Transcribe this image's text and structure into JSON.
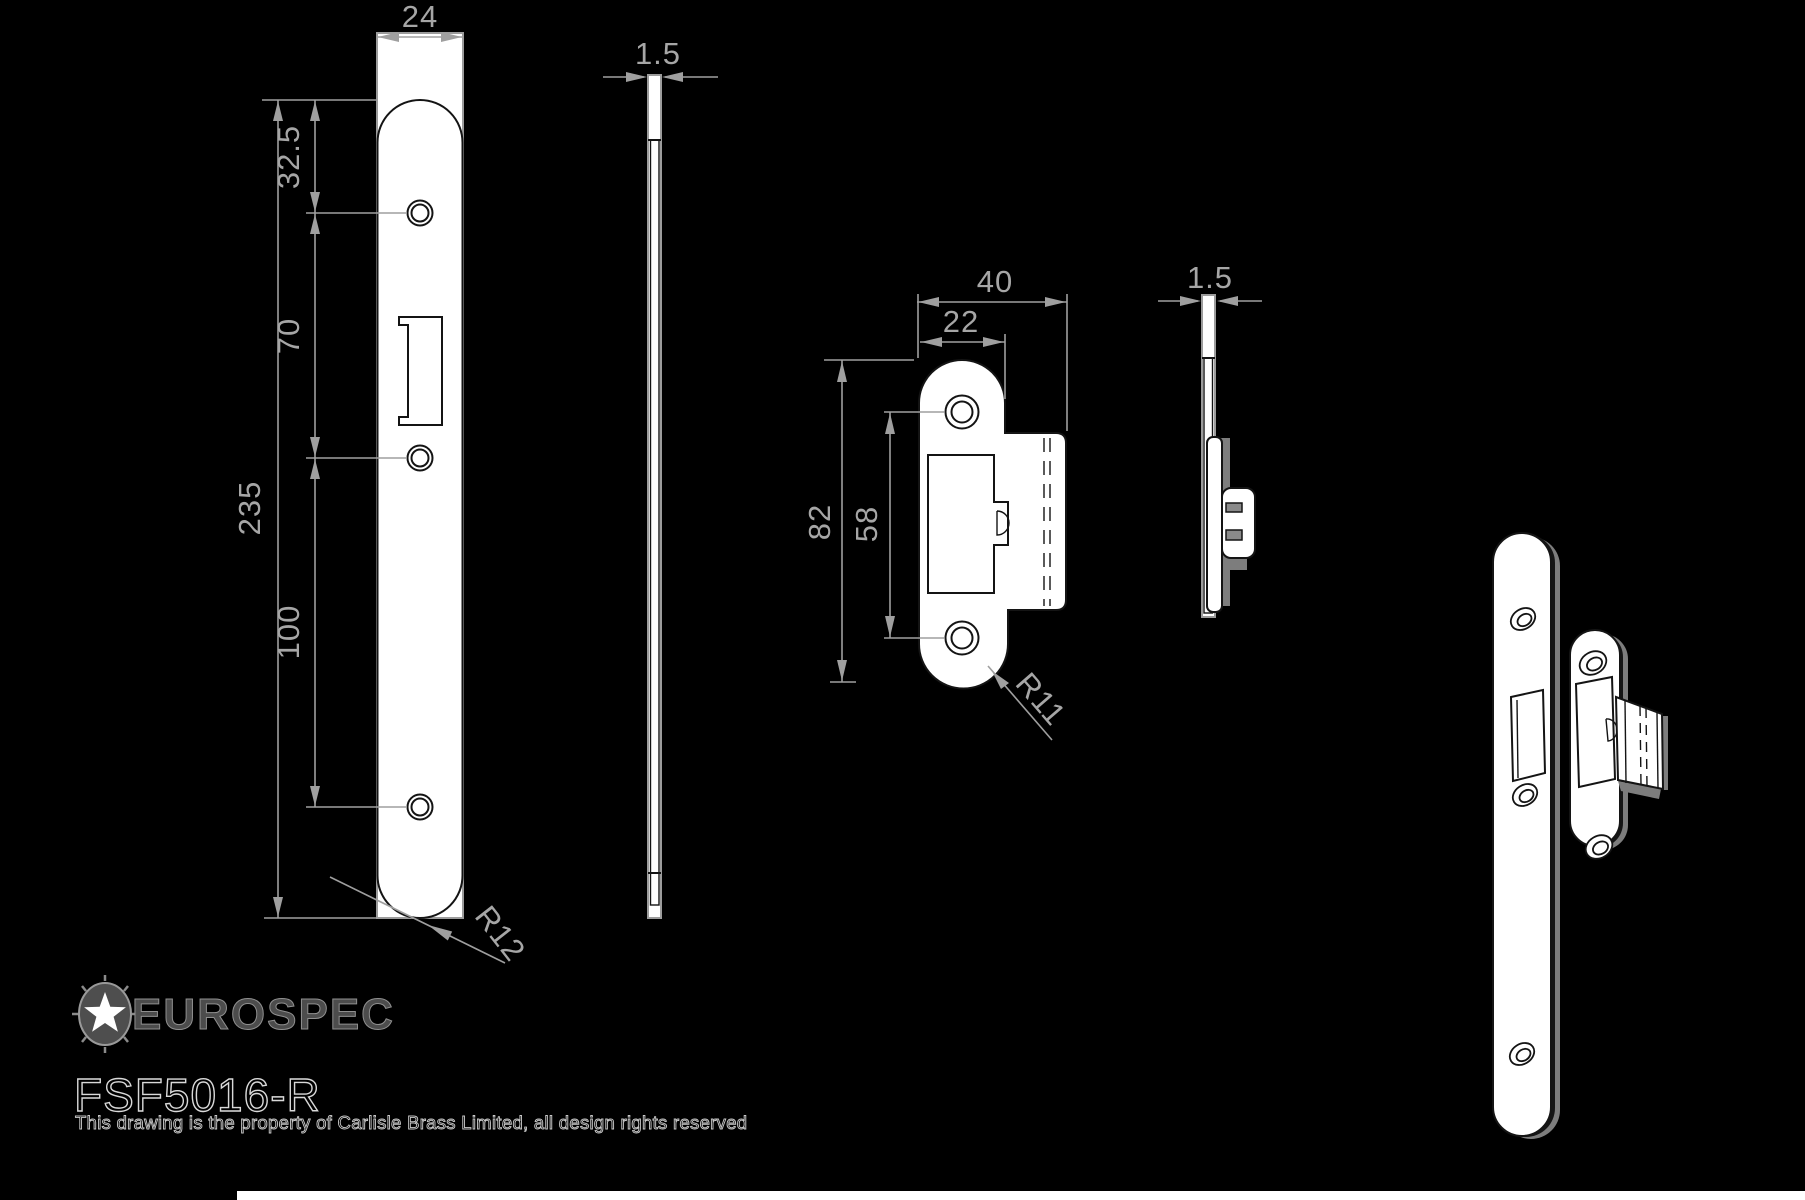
{
  "title_block": {
    "brand": "EUROSPEC",
    "part_number": "FSF5016-R",
    "disclaimer": "This drawing is the property of Carlisle Brass Limited, all design rights reserved"
  },
  "views": {
    "forend_front": {
      "name": "forend-face-view",
      "dims": {
        "width": "24",
        "top_offset": "32.5",
        "upper_spacing": "70",
        "lower_spacing": "100",
        "length": "235",
        "radius": "R12"
      }
    },
    "forend_side": {
      "name": "forend-edge-view",
      "dims": {
        "thickness": "1.5"
      }
    },
    "strike_front": {
      "name": "strike-face-view",
      "dims": {
        "overall_width": "40",
        "plate_width": "22",
        "length": "82",
        "hole_spacing": "58",
        "radius": "R11"
      }
    },
    "strike_side": {
      "name": "strike-edge-view",
      "dims": {
        "thickness": "1.5"
      }
    },
    "isometric": {
      "name": "isometric-view"
    }
  },
  "colors": {
    "background": "#000000",
    "plate_fill": "#ffffff",
    "outline_dark": "#141414",
    "outline_gray": "#9c9c9c",
    "dimension": "#a6a6a6",
    "shadow": "#7d7d7d",
    "bottom_bar": "#ffffff"
  }
}
